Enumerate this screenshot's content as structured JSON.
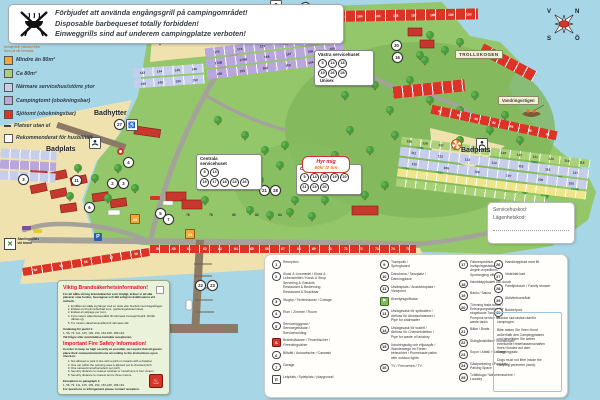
{
  "colors": {
    "water": "#A7D6E7",
    "sand": "#EFE2AF",
    "grass": "#94C66A",
    "plot_red": "#DD3327",
    "plot_purple": "#B9A6DD",
    "plot_blue": "#C7CEEC",
    "plot_green": "#A8D178",
    "plot_orange": "#F5A733",
    "accent_red": "#E8112D"
  },
  "warning": {
    "lines": [
      "Förbjudet att använda engångsgrill på campingområdet!",
      "Disposable barbequeset totally forbidden!",
      "Einweggrills sind auf underem campingplatze verboten!"
    ]
  },
  "size_legend": {
    "note": "Detaljerade platsstorlekar\nfinns på vår hemsida",
    "items": [
      {
        "swatch": "orange",
        "label": "Mindre än 80m²"
      },
      {
        "swatch": "green",
        "label": "Ca 80m²"
      },
      {
        "swatch": "blue",
        "label": "Närmare servicehus/större ytor"
      },
      {
        "swatch": "purple",
        "label": "Campingtomt (obokningsbar)"
      },
      {
        "swatch": "red",
        "label": "Sjötomt (obokningsbar)"
      },
      {
        "swatch": "dash",
        "label": "Platser utan el"
      },
      {
        "swatch": "outline",
        "label": "Rekommenderat för husbil/tält"
      }
    ]
  },
  "map": {
    "labels": {
      "klippbad": "Klippbad",
      "badhytter": "Badhytter",
      "badplats_left": "Badplats",
      "badplats_right": "Badplats",
      "trollskogen": "TROLLSKOGEN",
      "vandringsstigen": "Vandringsstigen"
    },
    "service_houses": [
      {
        "name": "Västra servicehuset",
        "rows": [
          [
            "5",
            "14",
            "18"
          ],
          [
            "19",
            "26",
            "28"
          ]
        ],
        "extra": "Unisex"
      },
      {
        "name": "Centrala\nservicehuset",
        "rows": [
          [
            "5",
            "14"
          ],
          [
            "15",
            "17",
            "18",
            "24",
            "26"
          ]
        ],
        "extra": ""
      },
      {
        "name": "Östra servicehuset",
        "rows": [
          [
            "5",
            "14",
            "15",
            "19",
            "20"
          ],
          [
            "21",
            "24",
            "26"
          ]
        ],
        "extra": ""
      }
    ],
    "bubble": {
      "line1": "Hyr mig",
      "line2": "60kr /2 tim"
    },
    "note_box": {
      "line1": "Servicehuskod:",
      "line2": "Lägenhetskod:"
    },
    "assembly": {
      "text": "Samlingsplats\nvid brand"
    },
    "compass": {
      "n": "N",
      "e": "Ö",
      "s": "S",
      "w": "V"
    },
    "markers": [
      {
        "n": "12",
        "x": 300,
        "y": 2
      },
      {
        "n": "27",
        "x": 114,
        "y": 119
      },
      {
        "n": "4",
        "x": 123,
        "y": 157
      },
      {
        "n": "11",
        "x": 71,
        "y": 175
      },
      {
        "n": "2",
        "x": 107,
        "y": 178
      },
      {
        "n": "3",
        "x": 118,
        "y": 178
      },
      {
        "n": "3",
        "x": 18,
        "y": 174
      },
      {
        "n": "6",
        "x": 84,
        "y": 202
      },
      {
        "n": "5",
        "x": 155,
        "y": 208
      },
      {
        "n": "7",
        "x": 163,
        "y": 214
      },
      {
        "n": "21",
        "x": 259,
        "y": 185
      },
      {
        "n": "28",
        "x": 270,
        "y": 185
      },
      {
        "n": "22",
        "x": 195,
        "y": 280
      },
      {
        "n": "23",
        "x": 207,
        "y": 280
      },
      {
        "n": "30",
        "x": 391,
        "y": 40
      },
      {
        "n": "16",
        "x": 392,
        "y": 52
      }
    ],
    "parking_markers": [
      {
        "n": "24",
        "x": 130,
        "y": 214
      },
      {
        "n": "24",
        "x": 185,
        "y": 229
      }
    ],
    "p_icons": [
      {
        "x": 94,
        "y": 233
      }
    ],
    "plot_numbers": {
      "top_row": [
        "181",
        "182",
        "183",
        "184",
        "185",
        "186",
        "187",
        "188",
        "189",
        "190"
      ],
      "purple_rows": [
        [
          "175",
          "174",
          "173",
          "179",
          "178",
          "177"
        ],
        [
          "172B",
          "170B",
          "168",
          "167",
          "166",
          "165"
        ],
        [
          "160",
          "161",
          "162",
          "163",
          "164",
          "169"
        ]
      ],
      "blue_rows": [
        [
          "143",
          "144",
          "145",
          "146"
        ],
        [
          "148",
          "149",
          "150",
          "152"
        ]
      ],
      "peninsula_rows": [
        [
          "129",
          "128",
          "127",
          "126",
          "125",
          "124",
          "123",
          "122",
          "121",
          "120",
          "119",
          "118"
        ],
        [
          "111",
          "112",
          "113",
          "114",
          "115",
          "116",
          "117"
        ],
        [
          "110",
          "109",
          "108",
          "107",
          "106",
          "105"
        ]
      ],
      "north_red_row": [
        "86",
        "88",
        "90",
        "92",
        "94",
        "96",
        "98"
      ],
      "mid_row": [
        "76",
        "78",
        "80",
        "82",
        "84"
      ],
      "shore_diag_row": [
        "54",
        "55",
        "56",
        "57",
        "58"
      ],
      "shore_row": [
        "59",
        "60",
        "61",
        "62",
        "63",
        "64",
        "65",
        "66",
        "67",
        "68",
        "69",
        "70",
        "71",
        "72",
        "73",
        "74",
        "75"
      ]
    }
  },
  "facility_legend": {
    "columns": [
      {
        "items": [
          {
            "num": "1",
            "text": "Reception"
          },
          {
            "num": "2",
            "text": "Kiosk & Livsmedel / Kiosk &\nLebensmittel / Kiosk & Shop\nServering & Gatukök\nRestaurant & Bedienung\nRestaurant & Snackbar"
          },
          {
            "num": "3",
            "text": "Stugby / Ferienhäuser / Cottage"
          },
          {
            "num": "4",
            "text": "Rum / Zimmer / Room"
          },
          {
            "num": "5",
            "text": "Servicebyggnad /\nServicegebäude /\nServicebuilding"
          },
          {
            "icon": "fire",
            "text": "Brandsläckare / Feuerlöscher /\nFireextinguisher"
          },
          {
            "num": "6",
            "text": "Biltvätt / Autowäsche / Carwash"
          },
          {
            "num": "7",
            "text": "Garage"
          },
          {
            "icon": "playground",
            "text": "Lekplats / Spielplatz / playground"
          }
        ]
      },
      {
        "items": [
          {
            "num": "9",
            "text": "Trampolin /\nSpringboard"
          },
          {
            "num": "10",
            "text": "Dansbana / Tanzplatz /\nDancingplace"
          },
          {
            "num": "11",
            "text": "Utsiktsplats / Aussichtsplatz /\nViewpoint"
          },
          {
            "icon": "golf",
            "text": "Äventyrsgolfbana"
          },
          {
            "num": "13",
            "text": "Utslagsvask för spillvatten /\nAbfluss für Abwaschwasser /\nPipe for drainwater"
          },
          {
            "num": "14",
            "text": "Utslagsvask för toalett /\nAbfluss für Chemietoiletten /\nPipe for waste of lavatory"
          },
          {
            "num": "15",
            "text": "Vandringsstig och elljusspår /\nWanderwege im Freien\nbeleuchtet / Promenade paths\nwith outdoor lights"
          },
          {
            "num": "16",
            "text": "TV / Fernsehen / TV"
          }
        ]
      },
      {
        "items": [
          {
            "num": "17",
            "text": "Fiskeexpedition,\nInvägningsstation /\nAngeln expedition /\nSportangling office"
          },
          {
            "num": "18",
            "text": "Handikapptoalett och dusch"
          },
          {
            "num": "19",
            "text": "Bastu / Sauna"
          },
          {
            "num": "20",
            "text": "Tömning fasta tankar /\nEntsorgungsstation für\neingebaute Tanks /\nPumpout service for\nwaste tanks"
          },
          {
            "num": "21",
            "text": "Båtar / Boats"
          },
          {
            "num": "22",
            "text": "Skärgårdsbåtar / Touristboats"
          },
          {
            "num": "23",
            "text": "Sopor / Abfall / Garbage"
          },
          {
            "num": "24",
            "text": "Gästparkering / Parkplatz /\nParking Space"
          },
          {
            "num": "25",
            "text": "Tvättstuga / Waschmaschine /\nLaundry"
          }
        ]
      },
      {
        "items": [
          {
            "num": "26",
            "text": "Handikappbad med lift"
          },
          {
            "num": "27",
            "text": "Vedeldat bad"
          },
          {
            "num": "28",
            "text": "Familjedusch / Family shower"
          },
          {
            "num": "29",
            "text": "Aktivitetsområde"
          },
          {
            "num": "30",
            "text": "Bubbelpool"
          }
        ]
      }
    ]
  },
  "dog_box": {
    "paragraphs": [
      "Hundar ska rastas utanför\ncampingen.",
      "Bitte rasten Sie Ihren Hund\naußerhalb des Campingplatzes\nund beseitigen Sie selber\neventuelle Hinterlassenschaften\nIhres Hundes auf dem\nCampingplatz.",
      "Dogs must not litter inside the\ncamping perimeter (area)."
    ]
  },
  "fire_info": {
    "sv": {
      "heading": "Viktig Brandsäkerhetsinformation!",
      "intro": "För att hålla så hög brandsäkerhet som möjligt, kräver vi att alla placerar sina fordon, husvagnar och tält enligt instruktionerna vid incheck.",
      "list": [
        "Ej tillåtet att ställa sig längst med en plats eller bredvid med dragstången.",
        "Endast en bil på incheckad tomt, (parkeringsbricka krävs).",
        "Endast ett ekipage per tomt.",
        "Fyra meters säkerhetsavstånd till närmaste husvagn/husbil. (förtält räknas ej).",
        "Tre meters säkerhetsavstånd till närmaste tält."
      ],
      "exception_label": "Undantag för punkt 1:",
      "exception": "1, 56, 79, 111, 125, 199, 154, 163-168, 189-194.",
      "footer": "Vid frågor eller överträdelse kontakta receptionen."
    },
    "en": {
      "heading": "Important Fire Safety Information!",
      "intro": "In order to keep as high security as possible, we require that all guests place their caravans/motorhome according to the instructions upon check-in.",
      "list": [
        "Not allowed to park in line with a pitch or inwards with a drawbar.",
        "One car within the camping area is allowed per in-checked pitch.",
        "One caravan/motorhome/tent per pitch.",
        "Security distance to nearest caravan or motorhome is four meters.",
        "Security distance to nearest tent is three meters."
      ],
      "exception_label": "Exceptions to paragraph 1:",
      "exception": "1, 56, 79, 111, 125, 199, 154, 163-168, 189-194.",
      "footer": "For questions or infringement please contact reception."
    }
  }
}
